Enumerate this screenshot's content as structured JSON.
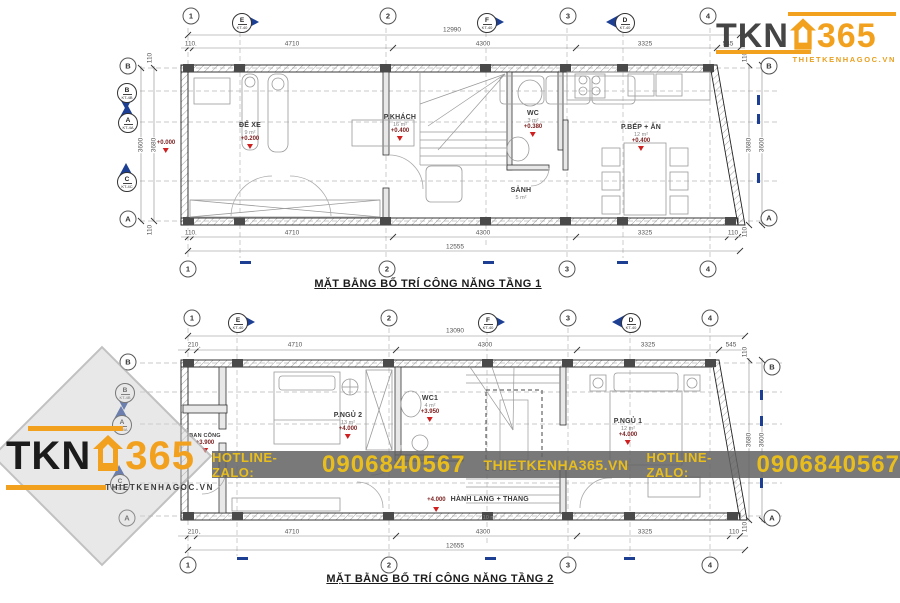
{
  "branding": {
    "colors": {
      "orange": "#F2A11E",
      "dark_gray": "#454545",
      "black": "#1b1b1b",
      "blue": "#1C3F94",
      "red": "#cf1f1f",
      "banner_text": "#E9BE1C"
    },
    "logo_top_right": {
      "tkn": "TKN",
      "n365": "365",
      "tagline": "THIETKENHAGOC.VN"
    },
    "logo_bottom_left": {
      "tkn": "TKN",
      "n365": "365",
      "tagline": "THIETKENHAGOC.VN"
    },
    "banner": {
      "label1": "HOTLINE-ZALO:",
      "phone1": "0906840567",
      "site": "THIETKENHA365.VN",
      "label2": "HOTLINE-ZALO:",
      "phone2": "0906840567"
    }
  },
  "plan1": {
    "title": "MẶT BẰNG BỐ TRÍ CÔNG NĂNG TẦNG 1",
    "grid": {
      "top_circles": [
        "1",
        "2",
        "3",
        "4"
      ],
      "top_diamonds": [
        {
          "l": "E",
          "s": "KT-40"
        },
        {
          "l": "F",
          "s": "KT-40"
        },
        {
          "l": "D",
          "s": "KT-40"
        }
      ],
      "bottom_circles": [
        "1",
        "2",
        "3",
        "4"
      ],
      "left_circles": [
        "B",
        "A"
      ],
      "left_diamonds": [
        {
          "l": "B",
          "s": "KT-4B"
        },
        {
          "l": "A",
          "s": "KT-4A"
        },
        {
          "l": "C",
          "s": "KT-4C"
        }
      ],
      "right_circles": [
        "B",
        "A"
      ]
    },
    "dims_top": {
      "overall": "12990",
      "segs": [
        "110",
        "4710",
        "4300",
        "3325",
        "545"
      ]
    },
    "dims_bottom": {
      "overall": "12555",
      "segs": [
        "110",
        "4710",
        "4300",
        "3325",
        "110"
      ]
    },
    "dims_left": {
      "a": "3600",
      "b": "3680",
      "t1": "110",
      "t2": "110"
    },
    "dims_right": {
      "a": "3680",
      "b": "3600",
      "t1": "110",
      "t2": "110"
    },
    "entry_level": "+0.000",
    "rooms": {
      "dexe": {
        "name": "ĐỂ XE",
        "area": "9 m²",
        "level": "+0.200"
      },
      "khach": {
        "name": "P.KHÁCH",
        "area": "16 m²",
        "level": "+0.400"
      },
      "wc": {
        "name": "WC",
        "area": "3 m²",
        "level": "+0.380"
      },
      "sanh": {
        "name": "SẢNH",
        "area": "5 m²"
      },
      "bep": {
        "name": "P.BẾP + ĂN",
        "area": "12 m²",
        "level": "+0.400"
      }
    }
  },
  "plan2": {
    "title": "MẶT BẰNG BỐ TRÍ CÔNG NĂNG TẦNG 2",
    "grid": {
      "top_circles": [
        "1",
        "2",
        "3",
        "4"
      ],
      "top_diamonds": [
        {
          "l": "E",
          "s": "KT-40"
        },
        {
          "l": "F",
          "s": "KT-40"
        },
        {
          "l": "D",
          "s": "KT-40"
        }
      ],
      "bottom_circles": [
        "1",
        "2",
        "3",
        "4"
      ],
      "left_circles": [
        "B",
        "A"
      ],
      "left_diamonds": [
        {
          "l": "B",
          "s": "KT-4B"
        },
        {
          "l": "A",
          "s": "KT-4A"
        },
        {
          "l": "C",
          "s": "KT-4C"
        }
      ],
      "right_circles": [
        "B",
        "A"
      ]
    },
    "dims_top": {
      "overall": "13090",
      "segs": [
        "210",
        "4710",
        "4300",
        "3325",
        "545"
      ]
    },
    "dims_bottom": {
      "overall": "12655",
      "segs": [
        "210",
        "4710",
        "4300",
        "3325",
        "110"
      ]
    },
    "dims_right": {
      "a": "3680",
      "b": "3600",
      "t1": "110",
      "t2": "110"
    },
    "rooms": {
      "bancong": {
        "name": "BAN CÔNG",
        "level": "+3.900"
      },
      "ngu2": {
        "name": "P.NGỦ 2",
        "area": "13 m²",
        "level": "+4.000"
      },
      "wc1": {
        "name": "WC1",
        "area": "4 m²",
        "level": "+3.950"
      },
      "ngu1": {
        "name": "P.NGỦ 1",
        "area": "12 m²",
        "level": "+4.000"
      },
      "hanhlang": {
        "level": "+4.000",
        "name": "HÀNH LANG + THANG",
        "area": "10 m²"
      }
    }
  }
}
